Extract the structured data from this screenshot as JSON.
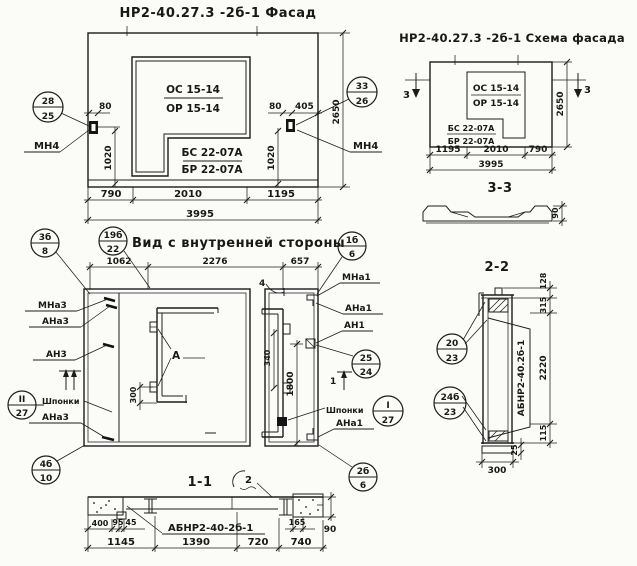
{
  "colors": {
    "ink": "#1c1c1c",
    "paper": "#fbfbf8"
  },
  "facade": {
    "title": "НР2-40.27.3 -2б-1 Фасад",
    "window_stamp": [
      "ОС 15-14",
      "ОР 15-14"
    ],
    "panel_stamp": [
      "БС 22-07А",
      "БР 22-07А"
    ],
    "callout_left": {
      "top": "28",
      "bottom": "25"
    },
    "callout_right": {
      "top": "33",
      "bottom": "26"
    },
    "anchor_label_left": "МН4",
    "anchor_label_right": "МН4",
    "dim_80_left": "80",
    "dim_80_right": "80",
    "dim_405": "405",
    "dim_1020_left": "1020",
    "dim_1020_right": "1020",
    "dim_2650": "2650",
    "dims_bottom": [
      "790",
      "2010",
      "1195"
    ],
    "dim_total": "3995"
  },
  "schema": {
    "title": "НР2-40.27.3 -2б-1 Схема фасада",
    "window_stamp": [
      "ОС 15-14",
      "ОР 15-14"
    ],
    "panel_stamp": [
      "БС 22-07А",
      "БР 22-07А"
    ],
    "section_mark_left": "3",
    "section_mark_right": "3",
    "dim_2650": "2650",
    "dims_bottom": [
      "1195",
      "2010",
      "790"
    ],
    "dim_total": "3995",
    "section_label": "3-3",
    "profile_dim": "90"
  },
  "inner_view": {
    "title": "Вид с внутренней стороны",
    "callout_title": {
      "top": "19б",
      "bottom": "22"
    },
    "callout_top_left": {
      "top": "3б",
      "bottom": "8"
    },
    "callout_top_right": {
      "top": "1б",
      "bottom": "6"
    },
    "callout_mid_right": {
      "top": "25",
      "bottom": "24"
    },
    "callout_keys_left": {
      "top": "II",
      "bottom": "27"
    },
    "callout_keys_right": {
      "top": "I",
      "bottom": "27"
    },
    "callout_bottom_left": {
      "top": "4б",
      "bottom": "10"
    },
    "callout_bottom_right": {
      "top": "2б",
      "bottom": "6"
    },
    "dims_top": [
      "1062",
      "2276",
      "657"
    ],
    "labels_left": [
      "МНа3",
      "АНа3",
      "АН3",
      "Шпонки",
      "АНа3"
    ],
    "labels_right": [
      "МНа1",
      "АНа1",
      "АН1",
      "Шпонки",
      "АНа1"
    ],
    "detail_a": "А",
    "mark_4": "4",
    "cut_mark": "1",
    "dim_300": "300",
    "dim_340": "340",
    "dim_1800": "1800"
  },
  "section_1_1": {
    "title": "1-1",
    "detail_mark": "2",
    "item_label": "АБНР2-40-2б-1",
    "dims_row1": [
      "400",
      "95",
      "45",
      "165"
    ],
    "dim_90": "90",
    "dims_row2": [
      "1145",
      "1390",
      "720",
      "740"
    ]
  },
  "section_2_2": {
    "title": "2-2",
    "item_label": "АБНР2-40.2б-1",
    "callout_top": {
      "top": "20",
      "bottom": "23"
    },
    "callout_bottom": {
      "top": "24б",
      "bottom": "23"
    },
    "dims_right": [
      "128",
      "315",
      "2220",
      "115"
    ],
    "dim_25": "25",
    "dim_300": "300"
  }
}
